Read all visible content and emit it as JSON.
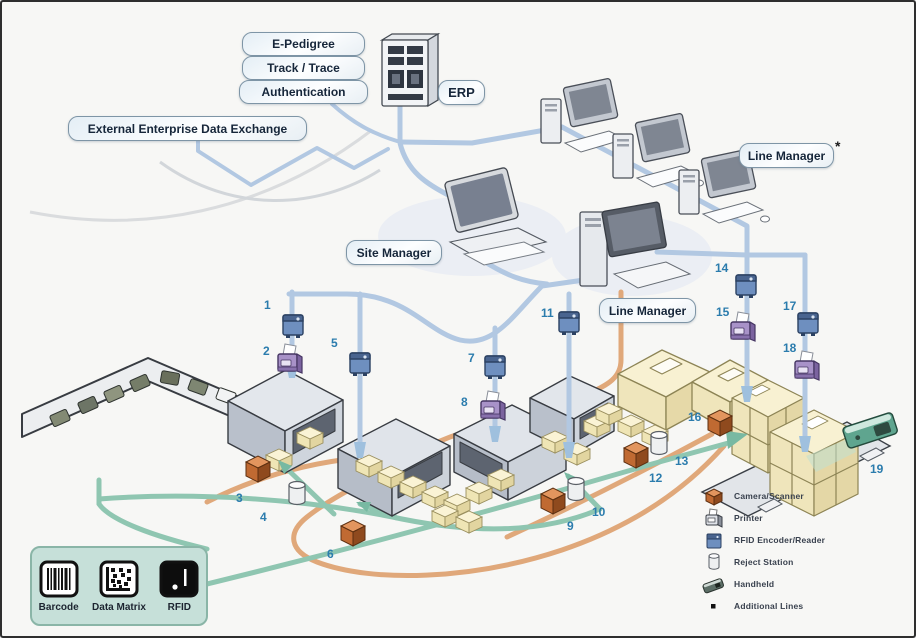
{
  "labels": {
    "e_pedigree": "E-Pedigree",
    "track_trace": "Track / Trace",
    "authentication": "Authentication",
    "external_exchange": "External Enterprise Data Exchange",
    "erp": "ERP",
    "site_manager": "Site Manager",
    "line_manager_top": "Line Manager",
    "line_manager_top_note": "*",
    "line_manager_mid": "Line Manager"
  },
  "steps": [
    "1",
    "2",
    "3",
    "4",
    "5",
    "6",
    "7",
    "8",
    "9",
    "10",
    "11",
    "12",
    "13",
    "14",
    "15",
    "16",
    "17",
    "18",
    "19"
  ],
  "device_legend": {
    "items": [
      {
        "icon": "camera-scanner-icon",
        "label": "Camera/Scanner"
      },
      {
        "icon": "printer-icon",
        "label": "Printer"
      },
      {
        "icon": "rfid-encoder-reader-icon",
        "label": "RFID Encoder/Reader"
      },
      {
        "icon": "reject-station-icon",
        "label": "Reject Station"
      },
      {
        "icon": "handheld-icon",
        "label": "Handheld"
      },
      {
        "icon": "additional-lines-icon",
        "label": "Additional Lines"
      }
    ]
  },
  "code_legend": {
    "items": [
      {
        "icon": "barcode-icon",
        "label": "Barcode"
      },
      {
        "icon": "data-matrix-icon",
        "label": "Data Matrix"
      },
      {
        "icon": "rfid-tag-icon",
        "label": "RFID"
      }
    ]
  },
  "colors": {
    "network_line": "#b2c8e2",
    "flow_orange": "#e0a87a",
    "flow_teal": "#8fc6b1",
    "step_number": "#2b7cad",
    "label_border": "#7e95a6",
    "code_legend_bg": "#c6e0d9"
  }
}
